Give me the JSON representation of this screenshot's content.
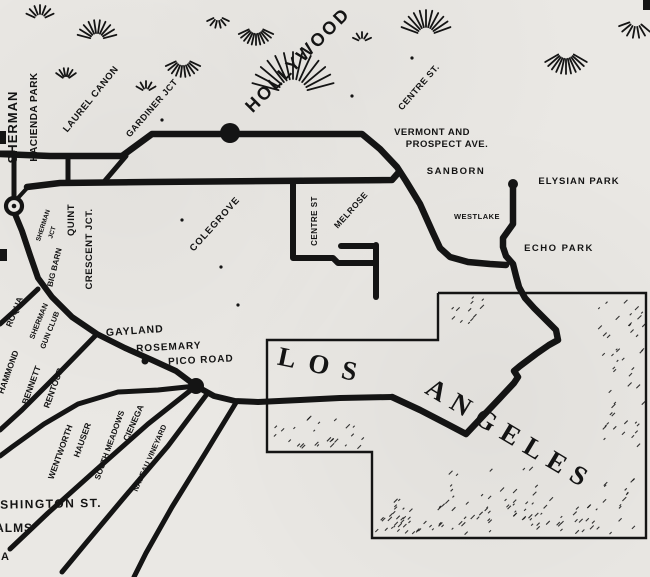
{
  "map": {
    "title": "Hollywood – Los Angeles railway map",
    "ink": "#141414",
    "paper": "#eae8e4",
    "labels": [
      {
        "id": "sherman-vertical",
        "t": "SHERMAN",
        "x": 17,
        "y": 127,
        "r": -90,
        "s": 13,
        "ls": 1
      },
      {
        "id": "hacienda-park",
        "t": "HACIENDA PARK",
        "x": 37,
        "y": 117,
        "r": -90,
        "s": 10,
        "ls": 0.5
      },
      {
        "id": "laurel-canon",
        "t": "LAUREL CANON",
        "x": 93,
        "y": 101,
        "r": -51,
        "s": 9.5,
        "ls": 0.5
      },
      {
        "id": "gardiner-jct",
        "t": "GARDINER JCT",
        "x": 154,
        "y": 110,
        "r": -49,
        "s": 9,
        "ls": 0.5
      },
      {
        "id": "hollywood",
        "t": "HOLLYWOOD",
        "x": 302,
        "y": 64,
        "r": -45,
        "s": 18,
        "ls": 2.5
      },
      {
        "id": "centre-st-upper",
        "t": "CENTRE ST.",
        "x": 421,
        "y": 89,
        "r": -49,
        "s": 9,
        "ls": 0.5
      },
      {
        "id": "vermont-and",
        "t": "VERMONT AND",
        "x": 432,
        "y": 135,
        "r": 0,
        "s": 9.5,
        "ls": 0.5
      },
      {
        "id": "prospect-ave",
        "t": "PROSPECT AVE.",
        "x": 447,
        "y": 147,
        "r": 0,
        "s": 9.5,
        "ls": 0.5
      },
      {
        "id": "sanborn",
        "t": "SANBORN",
        "x": 456,
        "y": 174,
        "r": 0,
        "s": 9.5,
        "ls": 1.5
      },
      {
        "id": "elysian-park",
        "t": "ELYSIAN PARK",
        "x": 579,
        "y": 184,
        "r": 0,
        "s": 9.5,
        "ls": 1
      },
      {
        "id": "westlake",
        "t": "WESTLAKE",
        "x": 477,
        "y": 219,
        "r": 0,
        "s": 7.5,
        "ls": 0.5
      },
      {
        "id": "echo-park",
        "t": "ECHO PARK",
        "x": 559,
        "y": 251,
        "r": 0,
        "s": 9.5,
        "ls": 1.5
      },
      {
        "id": "colegrove",
        "t": "COLEGROVE",
        "x": 217,
        "y": 226,
        "r": -48,
        "s": 9.5,
        "ls": 1
      },
      {
        "id": "centre-st-vertical",
        "t": "CENTRE ST",
        "x": 317,
        "y": 221,
        "r": -90,
        "s": 8,
        "ls": 0.5
      },
      {
        "id": "melrose",
        "t": "MELROSE",
        "x": 353,
        "y": 212,
        "r": -48,
        "s": 8.5,
        "ls": 0.5
      },
      {
        "id": "quint",
        "t": "QUINT",
        "x": 74,
        "y": 220,
        "r": -90,
        "s": 9.5,
        "ls": 0.5
      },
      {
        "id": "crescent-jct",
        "t": "CRESCENT JCT.",
        "x": 92,
        "y": 249,
        "r": -90,
        "s": 9.5,
        "ls": 0.5
      },
      {
        "id": "sherman-jct-1",
        "t": "SHERMAN",
        "x": 45,
        "y": 226,
        "r": -72,
        "s": 6.5,
        "ls": 0
      },
      {
        "id": "sherman-jct-2",
        "t": "JCT",
        "x": 54,
        "y": 233,
        "r": -72,
        "s": 6.5,
        "ls": 0
      },
      {
        "id": "big-barn",
        "t": "BIG BARN",
        "x": 57,
        "y": 268,
        "r": -76,
        "s": 8,
        "ls": 0
      },
      {
        "id": "roqua",
        "t": "ROQUA",
        "x": 17,
        "y": 313,
        "r": -68,
        "s": 8.5,
        "ls": 0
      },
      {
        "id": "sherman-gun-club-1",
        "t": "SHERMAN",
        "x": 41,
        "y": 322,
        "r": -68,
        "s": 7.5,
        "ls": 0
      },
      {
        "id": "sherman-gun-club-2",
        "t": "GUN CLUB",
        "x": 52,
        "y": 331,
        "r": -68,
        "s": 7.5,
        "ls": 0
      },
      {
        "id": "gayland",
        "t": "GAYLAND",
        "x": 135,
        "y": 334,
        "r": -4,
        "s": 10.5,
        "ls": 1
      },
      {
        "id": "rosemary",
        "t": "ROSEMARY",
        "x": 169,
        "y": 350,
        "r": -3,
        "s": 10,
        "ls": 1
      },
      {
        "id": "pico-road",
        "t": "PICO ROAD",
        "x": 201,
        "y": 363,
        "r": -3,
        "s": 10,
        "ls": 1
      },
      {
        "id": "hammond",
        "t": "HAMMOND",
        "x": 11,
        "y": 373,
        "r": -70,
        "s": 8.5,
        "ls": 0
      },
      {
        "id": "bennett",
        "t": "BENNETT",
        "x": 34,
        "y": 386,
        "r": -70,
        "s": 8.5,
        "ls": 0
      },
      {
        "id": "rentour",
        "t": "RENTOUR",
        "x": 56,
        "y": 389,
        "r": -70,
        "s": 8.5,
        "ls": 0
      },
      {
        "id": "wentworth",
        "t": "WENTWORTH",
        "x": 63,
        "y": 453,
        "r": -70,
        "s": 8.5,
        "ls": 0
      },
      {
        "id": "hauser",
        "t": "HAUSER",
        "x": 85,
        "y": 441,
        "r": -70,
        "s": 8.5,
        "ls": 0
      },
      {
        "id": "south-meadows",
        "t": "SOUTH MEADOWS",
        "x": 112,
        "y": 446,
        "r": -70,
        "s": 8,
        "ls": 0
      },
      {
        "id": "cienega",
        "t": "CIENEGA",
        "x": 136,
        "y": 424,
        "r": -66,
        "s": 8.5,
        "ls": 0
      },
      {
        "id": "nadeau-vineyard",
        "t": "NADEAU VINEYARD",
        "x": 152,
        "y": 459,
        "r": -66,
        "s": 7.5,
        "ls": 0
      },
      {
        "id": "washington-st",
        "t": "WASHINGTON ST.",
        "x": 40,
        "y": 508,
        "r": -1,
        "s": 12,
        "ls": 1.5
      },
      {
        "id": "palms",
        "t": "PALMS",
        "x": 10,
        "y": 532,
        "r": 0,
        "s": 12,
        "ls": 1
      },
      {
        "id": "cut-label-a",
        "t": "A",
        "x": 5,
        "y": 560,
        "r": 0,
        "s": 11,
        "ls": 0
      },
      {
        "id": "los",
        "t": "LOS",
        "x": 322,
        "y": 374,
        "r": 12,
        "s": 27,
        "ls": 13,
        "f": "serif"
      },
      {
        "id": "angeles",
        "t": "ANGELES",
        "x": 506,
        "y": 442,
        "r": 31,
        "s": 27,
        "ls": 9,
        "f": "serif"
      }
    ],
    "rail_lines": [
      {
        "name": "rail-hollywood-main-line",
        "w": 6.5,
        "pts": [
          [
            0,
            154
          ],
          [
            50,
            156
          ],
          [
            122,
            156
          ],
          [
            152,
            134
          ],
          [
            362,
            134
          ],
          [
            380,
            149
          ],
          [
            397,
            167
          ],
          [
            406,
            181
          ],
          [
            420,
            204
          ],
          [
            433,
            233
          ],
          [
            440,
            248
          ],
          [
            450,
            257
          ],
          [
            468,
            262
          ],
          [
            490,
            264
          ],
          [
            506,
            265
          ]
        ]
      },
      {
        "name": "rail-colegrove-line",
        "w": 6.5,
        "pts": [
          [
            27,
            187
          ],
          [
            60,
            183
          ],
          [
            150,
            182
          ],
          [
            392,
            180
          ],
          [
            399,
            172
          ]
        ]
      },
      {
        "name": "rail-connector-diagonal",
        "w": 5,
        "pts": [
          [
            103,
            183
          ],
          [
            126,
            156
          ]
        ]
      },
      {
        "name": "rail-connector-vertical",
        "w": 5,
        "pts": [
          [
            68,
            156
          ],
          [
            68,
            183
          ]
        ]
      },
      {
        "name": "rail-sherman-spur",
        "w": 5,
        "pts": [
          [
            0,
            153
          ],
          [
            14,
            153
          ],
          [
            14,
            197
          ]
        ]
      },
      {
        "name": "rail-sherman-wye",
        "w": 4,
        "pts": [
          [
            17,
            199
          ],
          [
            28,
            187
          ]
        ]
      },
      {
        "name": "rail-south-curve-pico",
        "w": 6,
        "pts": [
          [
            15,
            214
          ],
          [
            22,
            231
          ],
          [
            30,
            255
          ],
          [
            38,
            278
          ],
          [
            52,
            297
          ],
          [
            72,
            317
          ],
          [
            97,
            334
          ],
          [
            125,
            348
          ],
          [
            152,
            360
          ],
          [
            176,
            371
          ],
          [
            196,
            386
          ],
          [
            214,
            396
          ],
          [
            235,
            401
          ],
          [
            258,
            402
          ],
          [
            300,
            400
          ],
          [
            340,
            398
          ],
          [
            392,
            397
          ]
        ]
      },
      {
        "name": "rail-los-angeles-loop",
        "w": 6.5,
        "pts": [
          [
            392,
            397
          ],
          [
            420,
            410
          ],
          [
            447,
            424
          ],
          [
            466,
            434
          ],
          [
            482,
            417
          ],
          [
            500,
            398
          ],
          [
            514,
            383
          ],
          [
            518,
            377
          ],
          [
            514,
            371
          ],
          [
            520,
            366
          ],
          [
            536,
            354
          ],
          [
            549,
            345
          ],
          [
            558,
            340
          ],
          [
            556,
            330
          ],
          [
            546,
            320
          ],
          [
            534,
            308
          ],
          [
            525,
            298
          ],
          [
            519,
            287
          ],
          [
            516,
            276
          ],
          [
            513,
            264
          ],
          [
            506,
            256
          ],
          [
            503,
            247
          ],
          [
            503,
            238
          ],
          [
            508,
            231
          ],
          [
            513,
            224
          ],
          [
            513,
            186
          ]
        ]
      },
      {
        "name": "rail-melrose-loop",
        "w": 6,
        "pts": [
          [
            293,
            182
          ],
          [
            293,
            258
          ],
          [
            333,
            258
          ],
          [
            338,
            263
          ],
          [
            376,
            263
          ]
        ]
      },
      {
        "name": "rail-melrose-stub",
        "w": 6,
        "pts": [
          [
            376,
            245
          ],
          [
            376,
            297
          ]
        ]
      },
      {
        "name": "rail-melrose-horizontal",
        "w": 6,
        "pts": [
          [
            341,
            246
          ],
          [
            376,
            246
          ]
        ]
      },
      {
        "name": "rail-branch-west-1",
        "w": 5,
        "pts": [
          [
            38,
            289
          ],
          [
            20,
            306
          ],
          [
            0,
            324
          ]
        ]
      },
      {
        "name": "rail-branch-west-2",
        "w": 5,
        "pts": [
          [
            97,
            334
          ],
          [
            60,
            372
          ],
          [
            22,
            410
          ],
          [
            0,
            430
          ]
        ]
      },
      {
        "name": "rail-branch-west-3",
        "w": 5,
        "pts": [
          [
            196,
            386
          ],
          [
            158,
            390
          ],
          [
            118,
            392
          ],
          [
            78,
            404
          ],
          [
            44,
            424
          ],
          [
            12,
            447
          ],
          [
            0,
            456
          ]
        ]
      },
      {
        "name": "rail-branch-southwest-1",
        "w": 5,
        "pts": [
          [
            196,
            386
          ],
          [
            148,
            424
          ],
          [
            96,
            470
          ],
          [
            48,
            513
          ],
          [
            10,
            549
          ]
        ]
      },
      {
        "name": "rail-branch-southwest-2",
        "w": 5,
        "pts": [
          [
            207,
            394
          ],
          [
            168,
            446
          ],
          [
            122,
            500
          ],
          [
            86,
            543
          ],
          [
            62,
            572
          ]
        ]
      },
      {
        "name": "rail-branch-southwest-3",
        "w": 5,
        "pts": [
          [
            237,
            401
          ],
          [
            206,
            452
          ],
          [
            172,
            507
          ],
          [
            146,
            553
          ],
          [
            134,
            577
          ]
        ]
      }
    ],
    "boundary": {
      "name": "los-angeles-city-boundary",
      "w": 2.4,
      "pts": [
        [
          438,
          293
        ],
        [
          646,
          293
        ],
        [
          646,
          538
        ],
        [
          372,
          538
        ],
        [
          372,
          452
        ],
        [
          267,
          452
        ],
        [
          267,
          340
        ],
        [
          438,
          340
        ],
        [
          438,
          293
        ]
      ]
    },
    "stations": [
      {
        "name": "station-hollywood",
        "x": 230,
        "y": 133,
        "r": 10,
        "type": "dot"
      },
      {
        "name": "station-pico-road",
        "x": 196,
        "y": 386,
        "r": 8,
        "type": "dot"
      },
      {
        "name": "station-rosemary",
        "x": 145,
        "y": 361,
        "r": 3.5,
        "type": "dot"
      },
      {
        "name": "station-elysian-park",
        "x": 513,
        "y": 184,
        "r": 5,
        "type": "dot"
      },
      {
        "name": "station-sherman-terminal",
        "x": 14,
        "y": 206,
        "r": 8,
        "type": "ring"
      }
    ],
    "fans": [
      {
        "x": 40,
        "y": 20,
        "r0": 6,
        "r1": 15,
        "a0": 25,
        "a1": 155,
        "n": 7
      },
      {
        "x": 97,
        "y": 40,
        "r0": 7,
        "r1": 20,
        "a0": 15,
        "a1": 165,
        "n": 10
      },
      {
        "x": 66,
        "y": 80,
        "r0": 4,
        "r1": 12,
        "a0": 35,
        "a1": 145,
        "n": 6
      },
      {
        "x": 146,
        "y": 92,
        "r0": 4,
        "r1": 11,
        "a0": 30,
        "a1": 150,
        "n": 5
      },
      {
        "x": 183,
        "y": 58,
        "r0": 8,
        "r1": 19,
        "a0": 205,
        "a1": 335,
        "n": 10
      },
      {
        "x": 256,
        "y": 26,
        "r0": 8,
        "r1": 19,
        "a0": 205,
        "a1": 335,
        "n": 11
      },
      {
        "x": 293,
        "y": 94,
        "r0": 15,
        "r1": 42,
        "a0": 15,
        "a1": 165,
        "n": 13
      },
      {
        "x": 426,
        "y": 36,
        "r0": 9,
        "r1": 26,
        "a0": 20,
        "a1": 160,
        "n": 11
      },
      {
        "x": 566,
        "y": 50,
        "r0": 9,
        "r1": 24,
        "a0": 210,
        "a1": 330,
        "n": 11
      },
      {
        "x": 636,
        "y": 20,
        "r0": 7,
        "r1": 18,
        "a0": 200,
        "a1": 320,
        "n": 7
      },
      {
        "x": 362,
        "y": 42,
        "r0": 4,
        "r1": 10,
        "a0": 25,
        "a1": 155,
        "n": 5
      },
      {
        "x": 218,
        "y": 16,
        "r0": 5,
        "r1": 12,
        "a0": 205,
        "a1": 335,
        "n": 6
      }
    ],
    "stipples": [
      {
        "x": 380,
        "y": 500,
        "w": 255,
        "h": 35,
        "n": 70
      },
      {
        "x": 598,
        "y": 300,
        "w": 45,
        "h": 200,
        "n": 55
      },
      {
        "x": 270,
        "y": 418,
        "w": 95,
        "h": 32,
        "n": 26
      },
      {
        "x": 430,
        "y": 470,
        "w": 110,
        "h": 60,
        "n": 30
      },
      {
        "x": 446,
        "y": 298,
        "w": 40,
        "h": 26,
        "n": 12
      },
      {
        "x": 375,
        "y": 518,
        "w": 70,
        "h": 18,
        "n": 18
      }
    ],
    "specks": [
      [
        182,
        220
      ],
      [
        221,
        267
      ],
      [
        352,
        96
      ],
      [
        412,
        58
      ],
      [
        162,
        120
      ],
      [
        238,
        305
      ]
    ],
    "edge_marks": [
      {
        "x": 0,
        "y": 131,
        "w": 6,
        "h": 13
      },
      {
        "x": 0,
        "y": 249,
        "w": 7,
        "h": 12
      },
      {
        "x": 643,
        "y": 0,
        "w": 7,
        "h": 10
      }
    ]
  }
}
